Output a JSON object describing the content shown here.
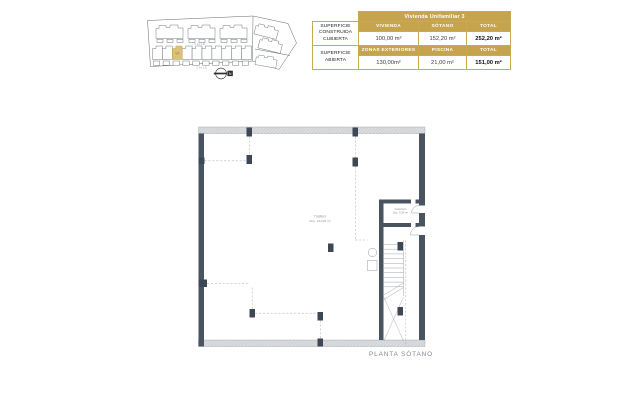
{
  "colors": {
    "gold": "#c6a44e",
    "wall_dark": "#4a5460",
    "highlight": "#ddc07a"
  },
  "site_plan": {
    "street_top": "CALLE",
    "street_bottom": "CALLE",
    "plot_label": "V3",
    "compass_label": "N"
  },
  "area_table": {
    "title": "Vivienda Unifamiliar 3",
    "groups": [
      {
        "label": "SUPERFICIE CONSTRUIDA CUBIERTA",
        "headers": [
          "VIVIENDA",
          "SÓTANO",
          "TOTAL"
        ],
        "values": [
          "100,00 m²",
          "152,20 m²",
          "252,20 m²"
        ]
      },
      {
        "label": "SUPERFICIE ABIERTA",
        "headers": [
          "ZONAS EXTERIORES",
          "PISCINA",
          "TOTAL"
        ],
        "values": [
          "130,00m²",
          "21,00 m²",
          "151,00 m²"
        ]
      }
    ]
  },
  "floor_plan": {
    "rooms": [
      {
        "name": "Trastero",
        "area": "Sup. 134,06 m²"
      },
      {
        "name": "Vestíbulo",
        "area": "Sup. 5,24 m²"
      }
    ],
    "caption": "PLANTA SÓTANO"
  }
}
